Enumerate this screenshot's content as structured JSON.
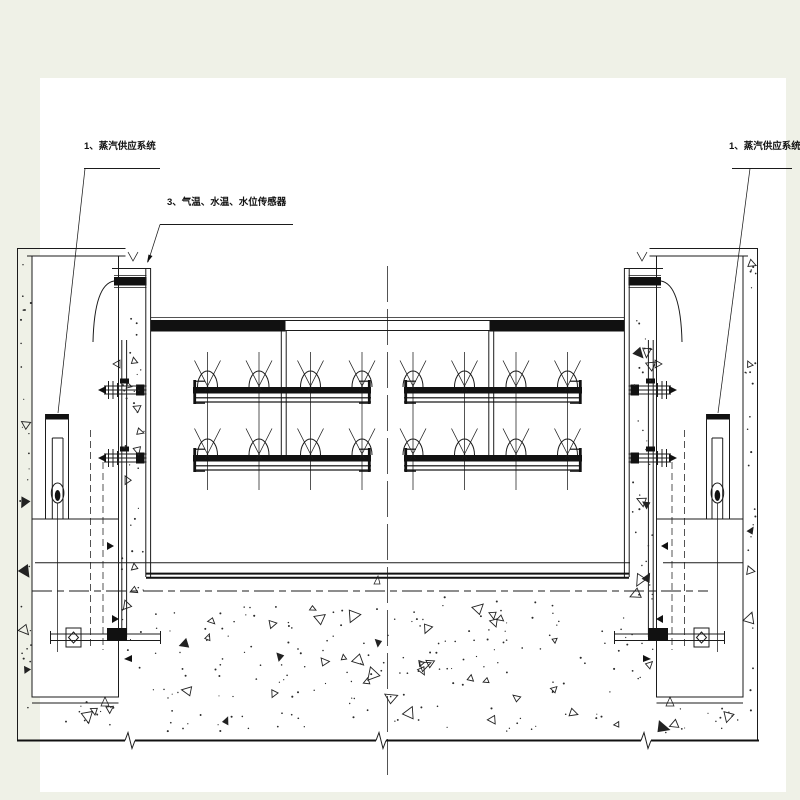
{
  "drawing": {
    "labels": {
      "steam_left": "1、蒸汽供应系统",
      "steam_right": "1、蒸汽供应系统",
      "sensors": "3、气温、水温、水位传感器"
    },
    "colors": {
      "line": "#1b1b1b",
      "paper": "#ffffff",
      "margin": "#eff1e7",
      "stipple": "#2a2a2a"
    }
  }
}
